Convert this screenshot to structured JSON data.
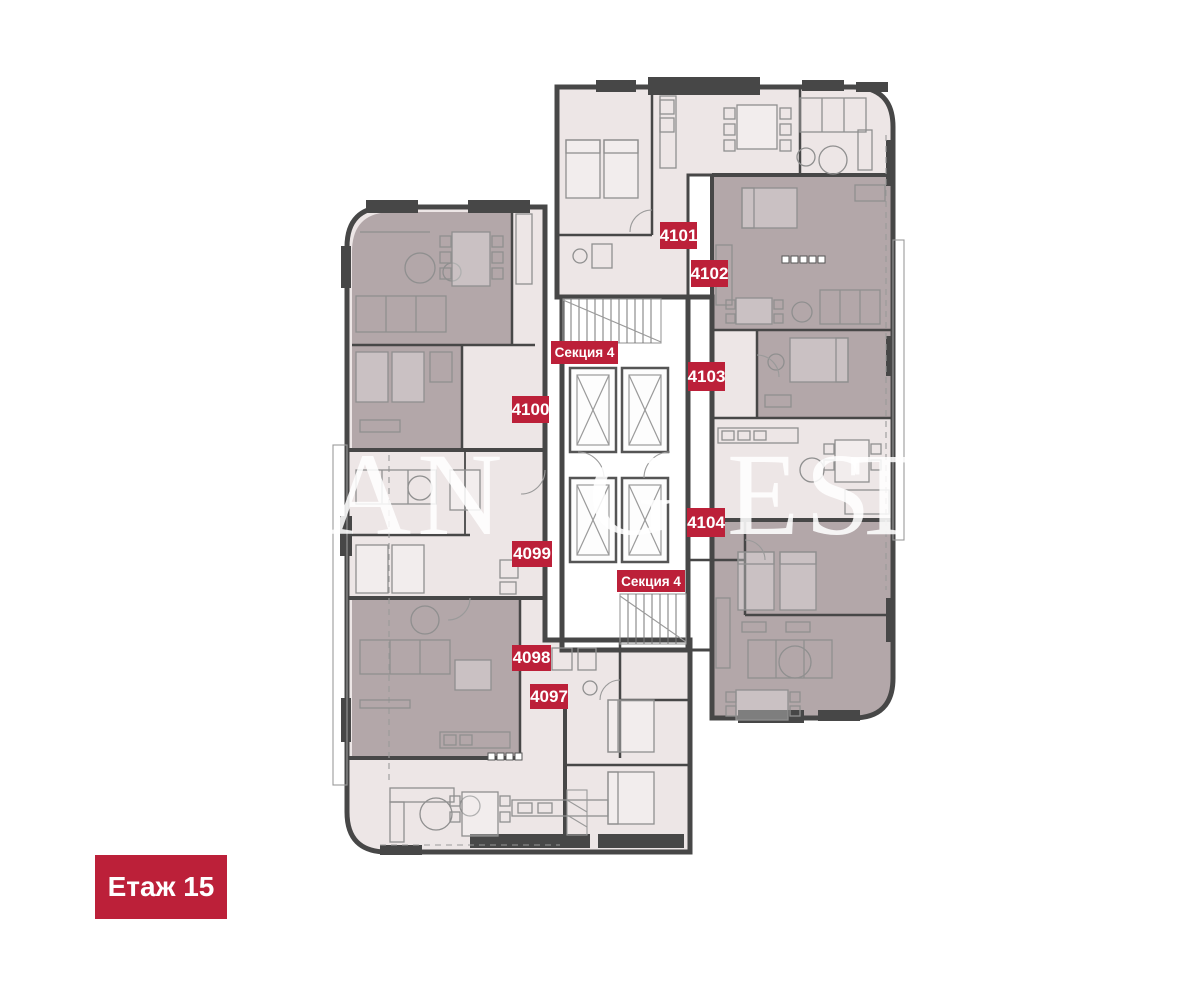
{
  "floor_label": "Етаж 15",
  "section_labels": {
    "top": "Секция 4",
    "bottom": "Секция 4"
  },
  "units": [
    {
      "id": "4097",
      "label": "4097"
    },
    {
      "id": "4098",
      "label": "4098"
    },
    {
      "id": "4099",
      "label": "4099"
    },
    {
      "id": "4100",
      "label": "4100"
    },
    {
      "id": "4101",
      "label": "4101"
    },
    {
      "id": "4102",
      "label": "4102"
    },
    {
      "id": "4103",
      "label": "4103"
    },
    {
      "id": "4104",
      "label": "4104"
    }
  ],
  "watermark": {
    "part1": "AN",
    "part2": "G",
    "part3": "ES",
    "part4": "T"
  },
  "colors": {
    "badge_red": "#BC2039",
    "room_light": "#EDE6E6",
    "room_dark": "#B3A7A9",
    "wall_dark": "#474747"
  }
}
